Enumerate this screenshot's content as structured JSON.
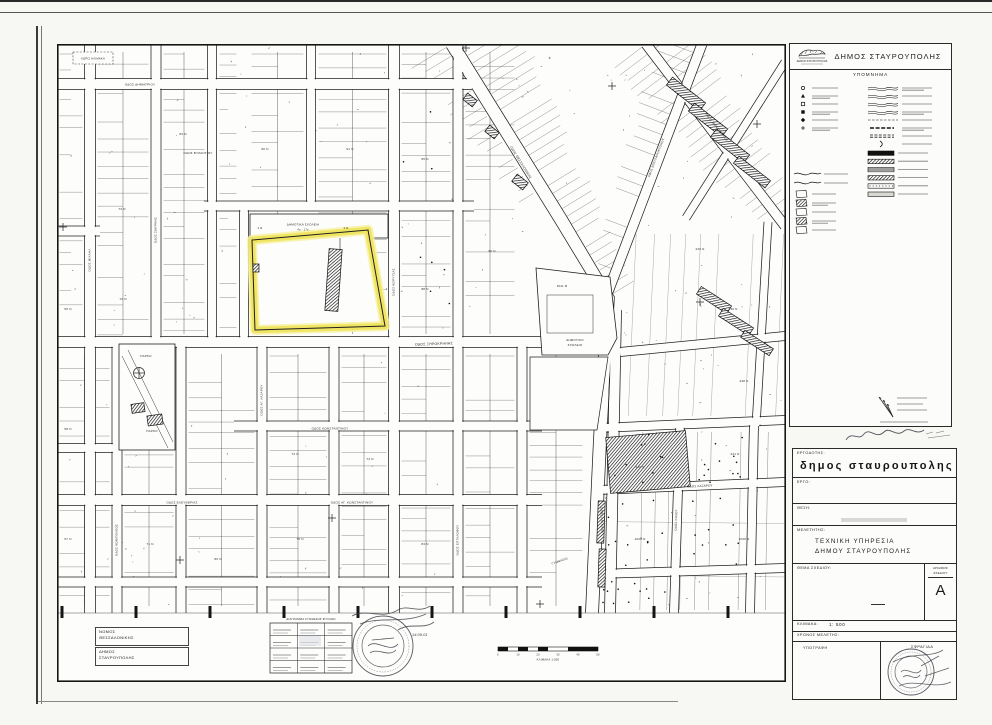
{
  "page": {
    "paper": "#fdfdfb",
    "ink": "#1c1c1c",
    "highlight": "#efe45f"
  },
  "header": {
    "municipality": "ΔΗΜΟΣ ΣΤΑΥΡΟΥΠΟΛΗΣ",
    "logo_caption": "ΔΗΜΟΣ ΣΤΑΥΡΟΥΠΟΛΗΣ"
  },
  "legend": {
    "title": "ΥΠΟΜΝΗΜΑ",
    "point_symbols": [
      "circle-marker",
      "triangle-marker",
      "square-marker",
      "square-filled-marker",
      "diamond-marker",
      "cross-marker"
    ],
    "wave_symbols": [
      "curb-line",
      "stream-line",
      "slope-line",
      "retaining-wall-line",
      "fence-line",
      "dashed-boundary",
      "double-track",
      "bracket-mark"
    ],
    "building_symbols": [
      "building-outline",
      "building-hatched",
      "building-public",
      "building-church",
      "building-ruin"
    ],
    "hatch_bars": [
      "solid-fill",
      "diagonal-hatch",
      "horizontal-hatch",
      "cross-hatch",
      "dot-fill",
      "light-fill"
    ]
  },
  "title_block": {
    "client_label": "ΕΡΓΟΔΟΤΗΣ:",
    "client": "δημος σταυρουπολης",
    "project_label": "ΕΡΓΟ:",
    "location_label": "ΘΕΣΗ:",
    "designer_label": "ΜΕΛΕΤΗΤΗΣ:",
    "designer_line1": "ΤΕΧΝΙΚΗ  ΥΠΗΡΕΣΙΑ",
    "designer_line2": "ΔΗΜΟΥ  ΣΤΑΥΡΟΥΠΟΛΗΣ",
    "subject_label": "ΘΕΜΑ  ΣΧΕΔΙΟΥ:",
    "number_label1": "ΑΡΙΘΜΟΣ",
    "number_label2": "ΣΧΕΔΙΟΥ",
    "number_value": "Α",
    "scale_label": "ΚΛΙΜΑΚΑ:",
    "scale_value": "1: 500",
    "date_label": "ΧΡΟΝΟΣ  ΜΕΛΕΤΗΣ:",
    "signature_label": "ΥΠΟΓΡΑΦΗ",
    "stamp_label": "ΣΦΡΑΓΙΔΑ"
  },
  "admin_boxes": [
    {
      "line1": "ΝΟΜΟΣ",
      "line2": "ΘΕΣΣΑΛΟΝΙΚΗΣ"
    },
    {
      "line1": "ΔΗΜΟΣ",
      "line2": "ΣΤΑΥΡΟΥΠΟΛΗΣ"
    }
  ],
  "map": {
    "no_scale_note": "ΧΩΡΙΣ ΚΛΙΜΑΚΑ",
    "sheet_diagram_title": "ΔΙΑΓΡΑΜΜΑ ΣΥΝΘΕΣΗΣ ΦΥΛΛΩΝ",
    "scalebar_caption": "ΚΛΙΜΑΚΑ 1:500",
    "scalebar_ticks": [
      "0",
      "10",
      "20",
      "30",
      "40",
      "50"
    ],
    "stamp_date": "14.09.01",
    "school_strip": {
      "label1": "ΔΗΜΟΤΙΚΑ ΣΧΟΛΕΙΑ",
      "label2": "4ο - 17ο",
      "mark_left": "3 Θ",
      "mark_right": "3 Θ"
    },
    "sports_block": {
      "area": "2641 Μ",
      "label1": "ΔΗΜΟΤΙΚΟ",
      "label2": "ΣΧΟΛΕΙΟ"
    },
    "park_label": "ΠΑΡΚΟ",
    "street_labels": [
      {
        "t": "ΟΔΟΣ ΔΗΜΗΤΡΙΟΥ",
        "x": 140,
        "y": 85.5,
        "r": 0,
        "s": 3.1
      },
      {
        "t": "ΟΔΟΣ ΒΥΖΑΝΤΙΟΥ",
        "x": 198,
        "y": 154,
        "r": 0,
        "s": 3.0
      },
      {
        "t": "ΟΔΟΣ ΞΗΡΟΚΡΗΝΗΣ",
        "x": 434,
        "y": 345,
        "r": -2,
        "s": 3.5
      },
      {
        "t": "ΟΔΟΣ ΚΩΝΣΤΑΝΤΙΝΟΥ",
        "x": 330,
        "y": 429.5,
        "r": 0,
        "s": 3.1
      },
      {
        "t": "ΟΔΟΣ ΑΓ. ΚΩΝΣΤΑΝΤΙΝΟΥ",
        "x": 352,
        "y": 503.5,
        "r": 0,
        "s": 3.1
      },
      {
        "t": "ΟΔΟΣ ΕΛΕΥΘΕΡΙΑΣ",
        "x": 182,
        "y": 503.5,
        "r": 0,
        "s": 3.0
      },
      {
        "t": "ΟΔΟΣ ΜΙΧΑΗΛ",
        "x": 90.5,
        "y": 260,
        "r": -90,
        "s": 3.0
      },
      {
        "t": "ΟΔΟΣ ΣΜΥΡΝΗΣ",
        "x": 156.5,
        "y": 230,
        "r": -90,
        "s": 3.0
      },
      {
        "t": "ΟΔΟΣ ΚΟΡΥΤΣΑΣ",
        "x": 394.5,
        "y": 282,
        "r": -90,
        "s": 3.0
      },
      {
        "t": "ΟΔΟΣ ΕΠΤΑΛΟΦΟΥ",
        "x": 458.5,
        "y": 540,
        "r": -90,
        "s": 3.0
      },
      {
        "t": "ΟΔΟΣ ΑΓ. ΛΑΖΑΡΟΥ",
        "x": 262.5,
        "y": 400,
        "r": -90,
        "s": 3.0
      },
      {
        "t": "ΟΔΟΣ ΚΩΝ/ΠΟΛΕΩΣ",
        "x": 117.5,
        "y": 540,
        "r": -90,
        "s": 3.0
      },
      {
        "t": "ΟΔΟΣ ΘΕΣΣΑΛΟΝΙΚΗΣ",
        "x": 520,
        "y": 163,
        "r": 58,
        "s": 3.2
      },
      {
        "t": "ΟΔΟΣ ΛΑΓΚΑΔΑ",
        "x": 601,
        "y": 520,
        "r": 88,
        "s": 3.2
      },
      {
        "t": "ΟΔΟΣ ΒΟΥΛΓΑΡΟΚΤΟΝΟΥ",
        "x": 657,
        "y": 158,
        "r": -69,
        "s": 3.0
      },
      {
        "t": "ΟΔΟΣ ΜΟΝΑΣΤΗΡΙΟΥ",
        "x": 716,
        "y": 128,
        "r": 52,
        "s": 3.0
      },
      {
        "t": "ΟΔΟΣ ΛΑΖΑΡΟΥ",
        "x": 700,
        "y": 487,
        "r": -3,
        "s": 3.0
      },
      {
        "t": "ΓΥΜΝΑΣΙΟ",
        "x": 560,
        "y": 562,
        "r": -20,
        "s": 3.0
      },
      {
        "t": "ΟΔΟΣ ΚΑΛΟΥ",
        "x": 677,
        "y": 520,
        "r": -88,
        "s": 3.0
      }
    ],
    "block_numbers": [
      {
        "t": "56 Ν",
        "x": 68,
        "y": 310
      },
      {
        "t": "73 Ν",
        "x": 122,
        "y": 210
      },
      {
        "t": "83 Ν",
        "x": 183,
        "y": 135
      },
      {
        "t": "90 Ν",
        "x": 265,
        "y": 150
      },
      {
        "t": "91 Ν",
        "x": 350,
        "y": 150
      },
      {
        "t": "72 Ν",
        "x": 123,
        "y": 300
      },
      {
        "t": "95 Ν",
        "x": 425,
        "y": 160
      },
      {
        "t": "88 Ν",
        "x": 425,
        "y": 290
      },
      {
        "t": "96 Ν",
        "x": 492,
        "y": 252
      },
      {
        "t": "73 Ν",
        "x": 295,
        "y": 455
      },
      {
        "t": "75 Ν",
        "x": 300,
        "y": 540
      },
      {
        "t": "71 Ν",
        "x": 150,
        "y": 545
      },
      {
        "t": "74 Ν",
        "x": 370,
        "y": 460
      },
      {
        "t": "229 Ν",
        "x": 700,
        "y": 250
      },
      {
        "t": "236 Ν",
        "x": 733,
        "y": 310
      },
      {
        "t": "238 Ν",
        "x": 744,
        "y": 382
      },
      {
        "t": "240 Ν",
        "x": 640,
        "y": 468
      },
      {
        "t": "241 Ν",
        "x": 735,
        "y": 455
      },
      {
        "t": "1029 Ν",
        "x": 640,
        "y": 540
      },
      {
        "t": "1030 Ν",
        "x": 744,
        "y": 540
      },
      {
        "t": "58 Ν",
        "x": 68,
        "y": 430
      },
      {
        "t": "57 Ν",
        "x": 68,
        "y": 540
      },
      {
        "t": "86 Ν",
        "x": 218,
        "y": 560
      },
      {
        "t": "84 Ν",
        "x": 425,
        "y": 545
      }
    ],
    "roads": [
      {
        "w": 11,
        "pts": [
          [
            54,
            84
          ],
          [
            472,
            84
          ]
        ]
      },
      {
        "w": 10,
        "pts": [
          [
            204,
            206
          ],
          [
            474,
            206
          ]
        ]
      },
      {
        "w": 10,
        "pts": [
          [
            54,
            231
          ],
          [
            100,
            231
          ]
        ]
      },
      {
        "w": 11,
        "pts": [
          [
            54,
            342
          ],
          [
            542,
            342
          ]
        ]
      },
      {
        "w": 10,
        "pts": [
          [
            234,
            426
          ],
          [
            542,
            426
          ]
        ]
      },
      {
        "w": 9,
        "pts": [
          [
            54,
            448
          ],
          [
            113,
            448
          ]
        ]
      },
      {
        "w": 11,
        "pts": [
          [
            54,
            500
          ],
          [
            542,
            500
          ]
        ]
      },
      {
        "w": 10,
        "pts": [
          [
            54,
            582
          ],
          [
            542,
            582
          ]
        ]
      },
      {
        "w": 11,
        "pts": [
          [
            90,
            44
          ],
          [
            90,
            613
          ]
        ]
      },
      {
        "w": 10,
        "pts": [
          [
            156,
            44
          ],
          [
            156,
            344
          ]
        ]
      },
      {
        "w": 9,
        "pts": [
          [
            212,
            44
          ],
          [
            212,
            344
          ]
        ]
      },
      {
        "w": 9,
        "pts": [
          [
            244,
            204
          ],
          [
            244,
            344
          ]
        ]
      },
      {
        "w": 9,
        "pts": [
          [
            311,
            44
          ],
          [
            311,
            208
          ]
        ]
      },
      {
        "w": 11,
        "pts": [
          [
            394,
            44
          ],
          [
            394,
            613
          ]
        ]
      },
      {
        "w": 10,
        "pts": [
          [
            458,
            44
          ],
          [
            458,
            613
          ]
        ]
      },
      {
        "w": 10,
        "pts": [
          [
            522,
            340
          ],
          [
            522,
            613
          ]
        ]
      },
      {
        "w": 10,
        "pts": [
          [
            117,
            346
          ],
          [
            117,
            613
          ]
        ]
      },
      {
        "w": 10,
        "pts": [
          [
            181,
            346
          ],
          [
            181,
            613
          ]
        ]
      },
      {
        "w": 10,
        "pts": [
          [
            262,
            346
          ],
          [
            262,
            613
          ]
        ]
      },
      {
        "w": 10,
        "pts": [
          [
            334,
            346
          ],
          [
            334,
            613
          ]
        ]
      },
      {
        "w": 13,
        "pts": [
          [
            452,
            44
          ],
          [
            560,
            218
          ],
          [
            608,
            298
          ],
          [
            600,
            440
          ],
          [
            592,
            613
          ]
        ]
      },
      {
        "w": 11,
        "pts": [
          [
            616,
            310
          ],
          [
            610,
            613
          ]
        ]
      },
      {
        "w": 10,
        "pts": [
          [
            702,
            44
          ],
          [
            608,
            292
          ]
        ]
      },
      {
        "w": 10,
        "pts": [
          [
            646,
            44
          ],
          [
            785,
            226
          ]
        ]
      },
      {
        "w": 8,
        "pts": [
          [
            785,
            62
          ],
          [
            686,
            218
          ]
        ]
      },
      {
        "w": 8,
        "pts": [
          [
            768,
            222
          ],
          [
            756,
            426
          ]
        ]
      },
      {
        "w": 9,
        "pts": [
          [
            620,
            352
          ],
          [
            785,
            336
          ]
        ]
      },
      {
        "w": 9,
        "pts": [
          [
            598,
            428
          ],
          [
            785,
            420
          ]
        ]
      },
      {
        "w": 9,
        "pts": [
          [
            598,
            490
          ],
          [
            785,
            482
          ]
        ]
      },
      {
        "w": 9,
        "pts": [
          [
            598,
            574
          ],
          [
            785,
            568
          ]
        ]
      },
      {
        "w": 9,
        "pts": [
          [
            680,
            426
          ],
          [
            674,
            613
          ]
        ]
      },
      {
        "w": 9,
        "pts": [
          [
            754,
            422
          ],
          [
            750,
            613
          ]
        ]
      }
    ],
    "buildings": [
      {
        "x": 333.5,
        "y": 280,
        "w": 13,
        "h": 62,
        "r": 4
      },
      {
        "x": 256,
        "y": 268,
        "w": 6,
        "h": 8,
        "r": 0
      },
      {
        "x": 686,
        "y": 94,
        "w": 42,
        "h": 10,
        "r": 38
      },
      {
        "x": 708,
        "y": 120,
        "w": 42,
        "h": 10,
        "r": 38
      },
      {
        "x": 730,
        "y": 146,
        "w": 42,
        "h": 10,
        "r": 38
      },
      {
        "x": 752,
        "y": 172,
        "w": 40,
        "h": 9,
        "r": 38
      },
      {
        "x": 714,
        "y": 300,
        "w": 36,
        "h": 9,
        "r": 33
      },
      {
        "x": 736,
        "y": 322,
        "w": 36,
        "h": 9,
        "r": 33
      },
      {
        "x": 757,
        "y": 343,
        "w": 34,
        "h": 8,
        "r": 33
      },
      {
        "x": 648,
        "y": 462,
        "w": 80,
        "h": 56,
        "r": -5
      },
      {
        "x": 601,
        "y": 522,
        "w": 7,
        "h": 42,
        "r": 2
      },
      {
        "x": 602,
        "y": 568,
        "w": 7,
        "h": 38,
        "r": 2
      },
      {
        "x": 520,
        "y": 182,
        "w": 14,
        "h": 9,
        "r": 38
      },
      {
        "x": 492,
        "y": 132,
        "w": 12,
        "h": 8,
        "r": 38
      },
      {
        "x": 470,
        "y": 100,
        "w": 12,
        "h": 8,
        "r": 38
      },
      {
        "x": 138,
        "y": 408,
        "w": 13,
        "h": 9,
        "r": -8
      },
      {
        "x": 155,
        "y": 420,
        "w": 15,
        "h": 10,
        "r": -8
      }
    ],
    "crosses": [
      [
        63,
        227
      ],
      [
        332,
        518
      ],
      [
        466,
        48
      ],
      [
        612,
        86
      ],
      [
        757,
        124
      ],
      [
        700,
        302
      ],
      [
        180,
        560
      ],
      [
        540,
        604
      ]
    ]
  }
}
